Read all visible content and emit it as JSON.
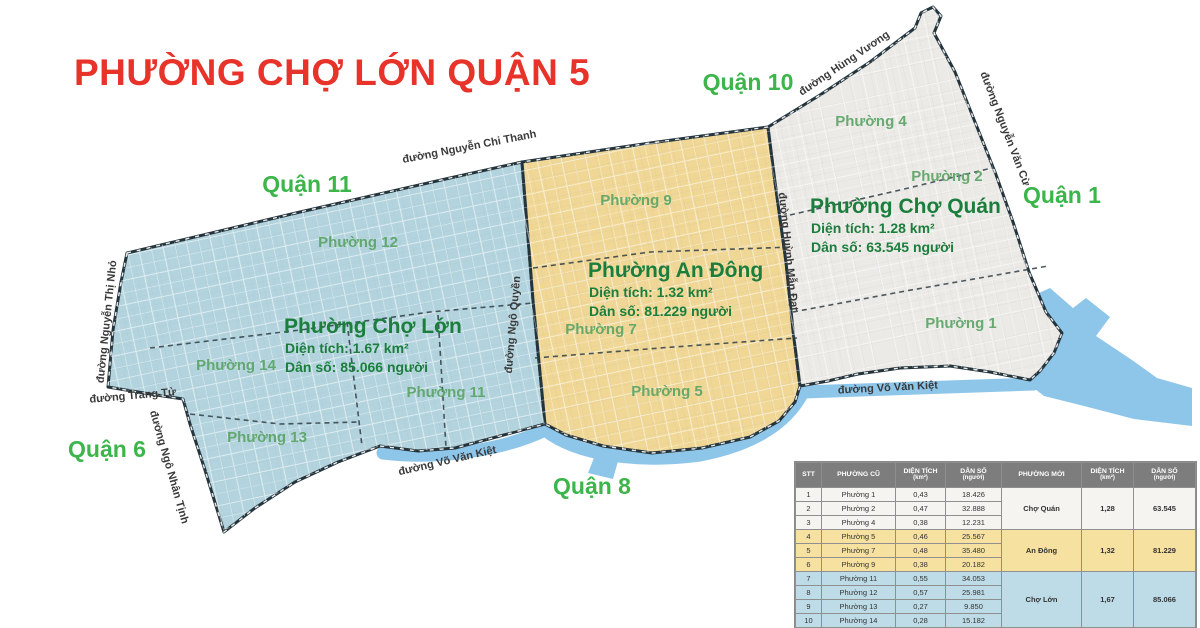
{
  "title": {
    "text": "PHƯỜNG CHỢ LỚN QUẬN 5"
  },
  "map": {
    "districts": [
      {
        "label": "Quận 11"
      },
      {
        "label": "Quận 10"
      },
      {
        "label": "Quận 1"
      },
      {
        "label": "Quận 6"
      },
      {
        "label": "Quận 8"
      }
    ],
    "streets": [
      {
        "label": "đường Nguyễn Chi Thanh"
      },
      {
        "label": "đường Hùng Vương"
      },
      {
        "label": "đường Nguyễn Văn Cừ"
      },
      {
        "label": "đường Nguyễn Thị Nhỏ"
      },
      {
        "label": "đường Trang Tử"
      },
      {
        "label": "đường Ngô Nhân Tịnh"
      },
      {
        "label": "đường Võ Văn Kiệt"
      },
      {
        "label": "đường Võ Văn Kiệt"
      },
      {
        "label": "đường Ngô Quyền"
      },
      {
        "label": "đường Huỳnh Mẫn Đạt"
      }
    ],
    "old_wards": [
      {
        "label": "Phường 12"
      },
      {
        "label": "Phường 14"
      },
      {
        "label": "Phường 11"
      },
      {
        "label": "Phường 13"
      },
      {
        "label": "Phường 9"
      },
      {
        "label": "Phường 7"
      },
      {
        "label": "Phường 5"
      },
      {
        "label": "Phường 4"
      },
      {
        "label": "Phường 2"
      },
      {
        "label": "Phường 1"
      }
    ],
    "regions": [
      {
        "name": "Phường Chợ Lớn",
        "area": "Diện tích: 1.67 km²",
        "population": "Dân số: 85.066 người",
        "fill": "#b3d4de"
      },
      {
        "name": "Phường An Đông",
        "area": "Diện tích: 1.32 km²",
        "population": "Dân số: 81.229 người",
        "fill": "#f0d795"
      },
      {
        "name": "Phường Chợ Quán",
        "area": "Diện tích: 1.28 km²",
        "population": "Dân số: 63.545 người",
        "fill": "#eceae6"
      }
    ],
    "colors": {
      "water": "#8ec6ea",
      "border": "#24343c",
      "district_label": "#3cb54a",
      "ward_label": "#5aa365",
      "region_text": "#1b7e3c",
      "title_red": "#e8332a"
    }
  },
  "table": {
    "header": {
      "stt": "STT",
      "old_ward": "PHƯỜNG CŨ",
      "area": "DIỆN TÍCH",
      "area_unit": "(km²)",
      "population": "DÂN SỐ",
      "population_unit": "(người)",
      "new_ward": "PHƯỜNG MỚI"
    },
    "rows": [
      {
        "stt": "1",
        "ward": "Phường 1",
        "area": "0,43",
        "population": "18.426"
      },
      {
        "stt": "2",
        "ward": "Phường 2",
        "area": "0,47",
        "population": "32.888"
      },
      {
        "stt": "3",
        "ward": "Phường 4",
        "area": "0,38",
        "population": "12.231"
      },
      {
        "stt": "4",
        "ward": "Phường 5",
        "area": "0,46",
        "population": "25.567"
      },
      {
        "stt": "5",
        "ward": "Phường 7",
        "area": "0,48",
        "population": "35.480"
      },
      {
        "stt": "6",
        "ward": "Phường 9",
        "area": "0,38",
        "population": "20.182"
      },
      {
        "stt": "7",
        "ward": "Phường 11",
        "area": "0,55",
        "population": "34.053"
      },
      {
        "stt": "8",
        "ward": "Phường 12",
        "area": "0,57",
        "population": "25.981"
      },
      {
        "stt": "9",
        "ward": "Phường 13",
        "area": "0,27",
        "population": "9.850"
      },
      {
        "stt": "10",
        "ward": "Phường 14",
        "area": "0,28",
        "population": "15.182"
      }
    ],
    "groups": [
      {
        "name": "Chợ Quán",
        "area": "1,28",
        "population": "63.545"
      },
      {
        "name": "An Đông",
        "area": "1,32",
        "population": "81.229"
      },
      {
        "name": "Chợ Lớn",
        "area": "1,67",
        "population": "85.066"
      }
    ]
  }
}
